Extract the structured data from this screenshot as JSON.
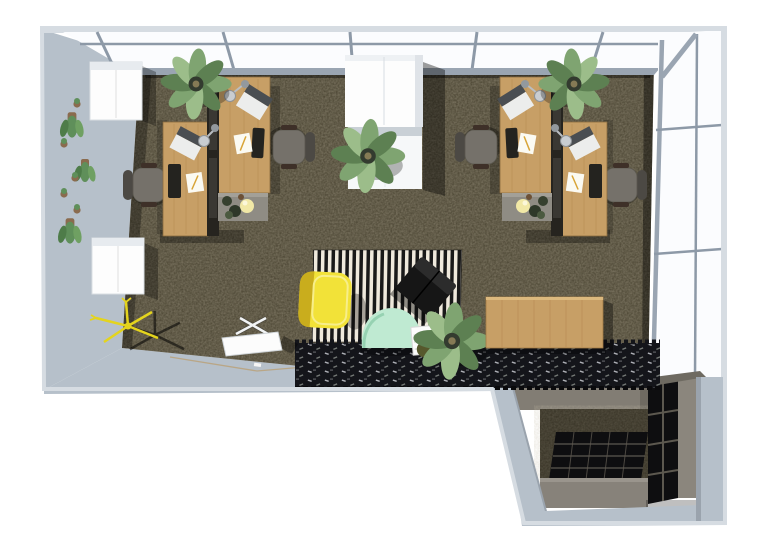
{
  "meta": {
    "title": "3D top-down render of an L-shaped office with two workstation clusters, lounge rugs and annex shelving",
    "width": 766,
    "height": 551
  },
  "palette": {
    "bg": "#ffffff",
    "wall": "#b6c0ca",
    "wall_edge": "#d6dce2",
    "glass": "#fbfcfe",
    "mullion": "#8d99a7",
    "frame": "#9aa5b2",
    "carpet": "#47412f",
    "carpet_speck": "#8d8568",
    "shadow": "#14110c",
    "wood": "#c79f66",
    "wood_grain": "#b08349",
    "divider": "#26241f",
    "divider_panel": "#3a3833",
    "chair_seat": "#75716a",
    "chair_back": "#4c4944",
    "chair_arm": "#3e3028",
    "pedestal": "#8f8c84",
    "sphere_lamp": "#f1e8a6",
    "laptop_body": "#ecedec",
    "laptop_screen": "#4a4e52",
    "keyboard": "#24231f",
    "paper": "#fbfaf2",
    "pencil": "#d8a437",
    "chrome": "#c9cdd1",
    "plant_green": "#7fa471",
    "plant_green_dark": "#5d8052",
    "plant_green_light": "#9cbd8a",
    "pot_dark": "#333b2f",
    "pot_brown": "#8a6b4e",
    "wallplant_green": "#5f8f5a",
    "cabinet_white": "#fdfdfd",
    "cabinet_shade": "#c9d0d6",
    "stripe_dark": "#191919",
    "stripe_light": "#efe9dc",
    "shag": "#14151a",
    "shag_fleck": "#c9ccd1",
    "chair_yellow": "#f2e238",
    "chair_yellow_dark": "#c9ad1d",
    "chair_black": "#161616",
    "chair_mint": "#bfead2",
    "mint_rim": "#96d2b2",
    "side_table": "#fcfcfc",
    "bowl_dark": "#56582c",
    "bowl_yellow": "#d6d252",
    "coat_rack": "#e4d41d",
    "annex_band": "#827d74",
    "annex_cabinet": "#87827a",
    "shelf_black": "#0e0e10",
    "shelf_line": "#5c584f",
    "shelf_side": "#8b867d",
    "door_line": "#b9a37e"
  },
  "scene": {
    "room_shape": "L-shaped office, bird's-eye 3D view",
    "items": [
      "glass-curtain-wall-top",
      "glass-curtain-wall-right",
      "left-wall-hanging-plants",
      "wall-cabinet-upper",
      "wall-cabinet-lower",
      "workstation-cluster-left",
      "workstation-cluster-right",
      "tall-white-cabinet-with-plant",
      "striped-rug",
      "black-shag-rug",
      "yellow-armchair",
      "black-armchair",
      "mint-lounge-chair",
      "side-table-with-magazines",
      "lounge-potted-plant",
      "wooden-sideboard",
      "yellow-coat-stand",
      "white-folding-table",
      "annex-cube-shelving"
    ]
  }
}
